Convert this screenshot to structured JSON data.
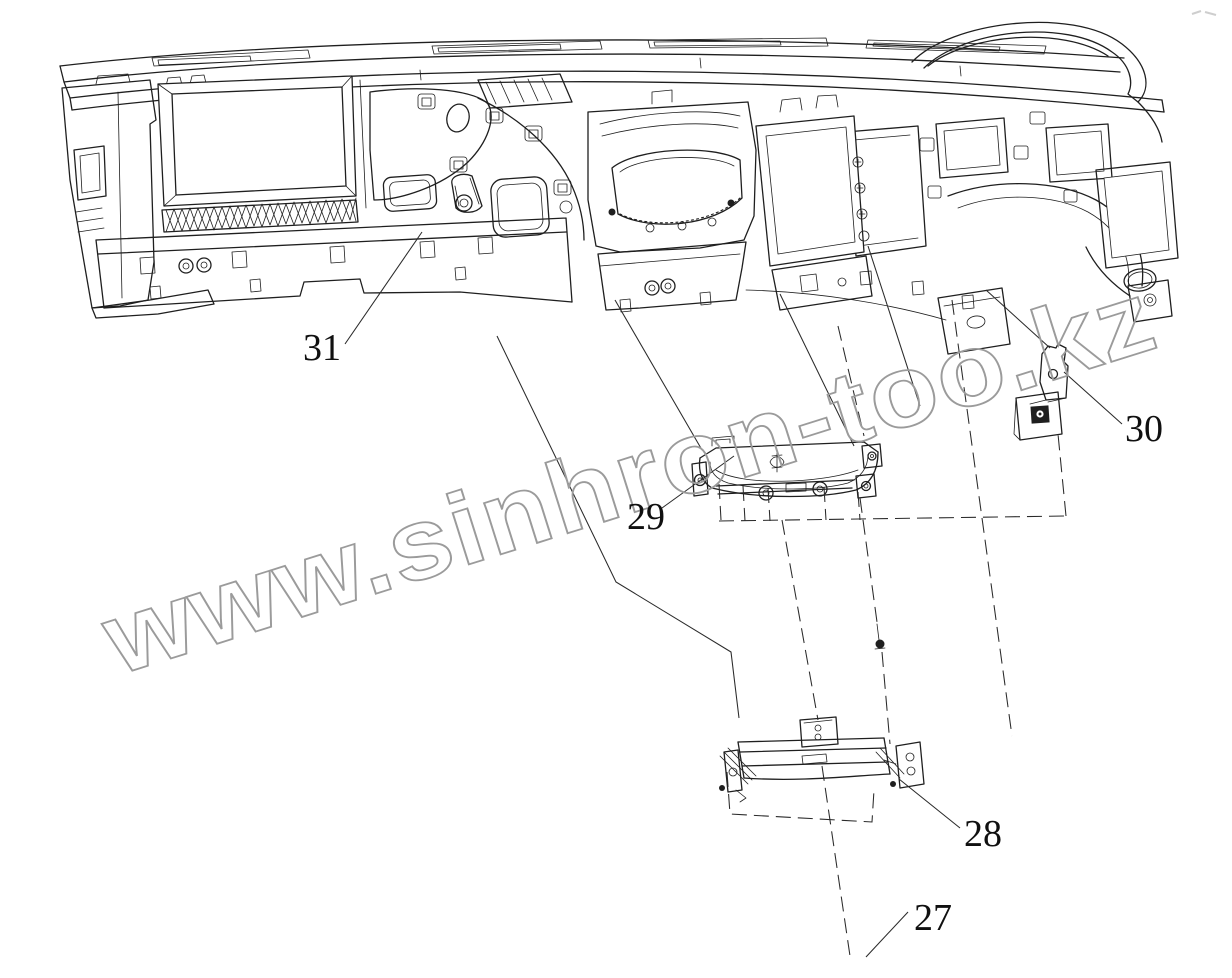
{
  "diagram": {
    "type": "exploded-parts-line-drawing",
    "subject": "vehicle instrument panel assembly",
    "watermark_text": "www.sinhron-too.kz",
    "callouts": {
      "c27": "27",
      "c28": "28",
      "c29": "29",
      "c30": "30",
      "c31": "31"
    },
    "colors": {
      "line": "#1f1f1f",
      "background": "#ffffff",
      "watermark": "#9b9b9b",
      "label_text": "#101010"
    }
  }
}
